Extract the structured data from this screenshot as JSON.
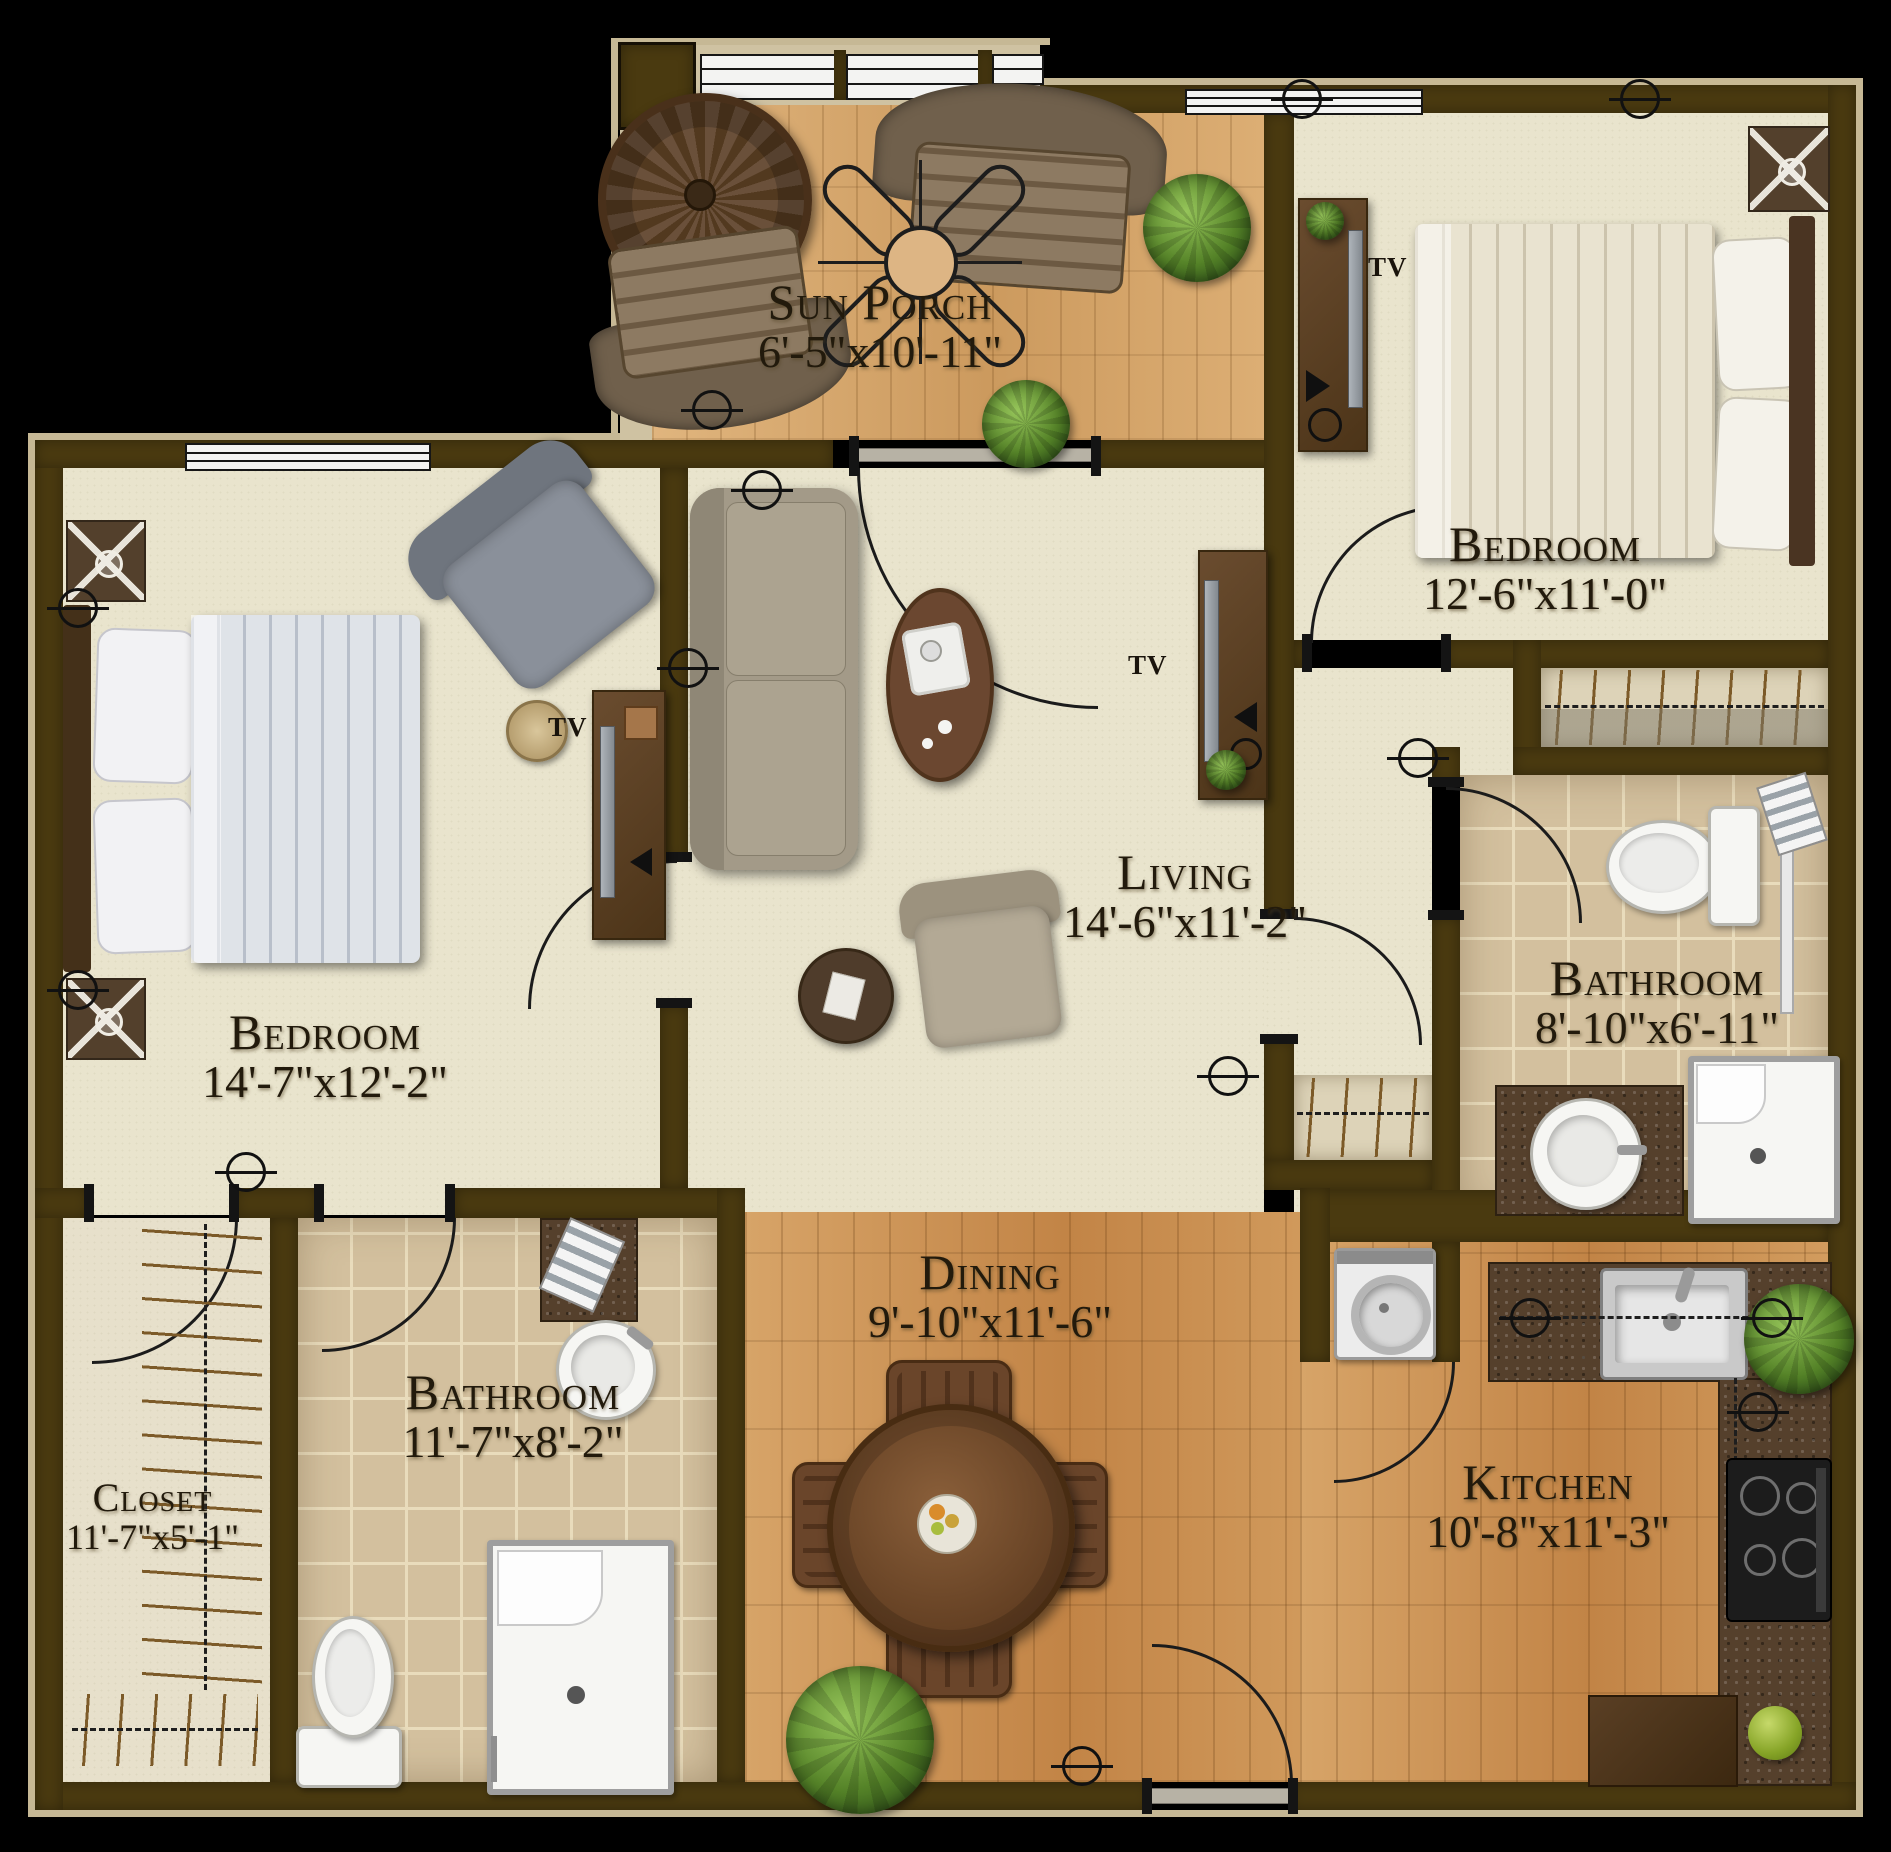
{
  "rooms": {
    "sun_porch": {
      "name": "Sun Porch",
      "dims": "6'-5\"x10'-11\""
    },
    "bedroom_right": {
      "name": "Bedroom",
      "dims": "12'-6\"x11'-0\""
    },
    "bedroom_left": {
      "name": "Bedroom",
      "dims": "14'-7\"x12'-2\""
    },
    "living": {
      "name": "Living",
      "dims": "14'-6\"x11'-2\""
    },
    "bathroom_right": {
      "name": "Bathroom",
      "dims": "8'-10\"x6'-11\""
    },
    "bathroom_left": {
      "name": "Bathroom",
      "dims": "11'-7\"x8'-2\""
    },
    "closet": {
      "name": "Closet",
      "dims": "11'-7\"x5'-1\""
    },
    "dining": {
      "name": "Dining",
      "dims": "9'-10\"x11'-6\""
    },
    "kitchen": {
      "name": "Kitchen",
      "dims": "10'-8\"x11'-3\""
    }
  },
  "labels": {
    "tv": "TV"
  },
  "colors": {
    "wall": "#4a3a10",
    "carpet": "#e9e4cd",
    "wood": "#cf9a5c",
    "tile": "#d3c09e"
  }
}
